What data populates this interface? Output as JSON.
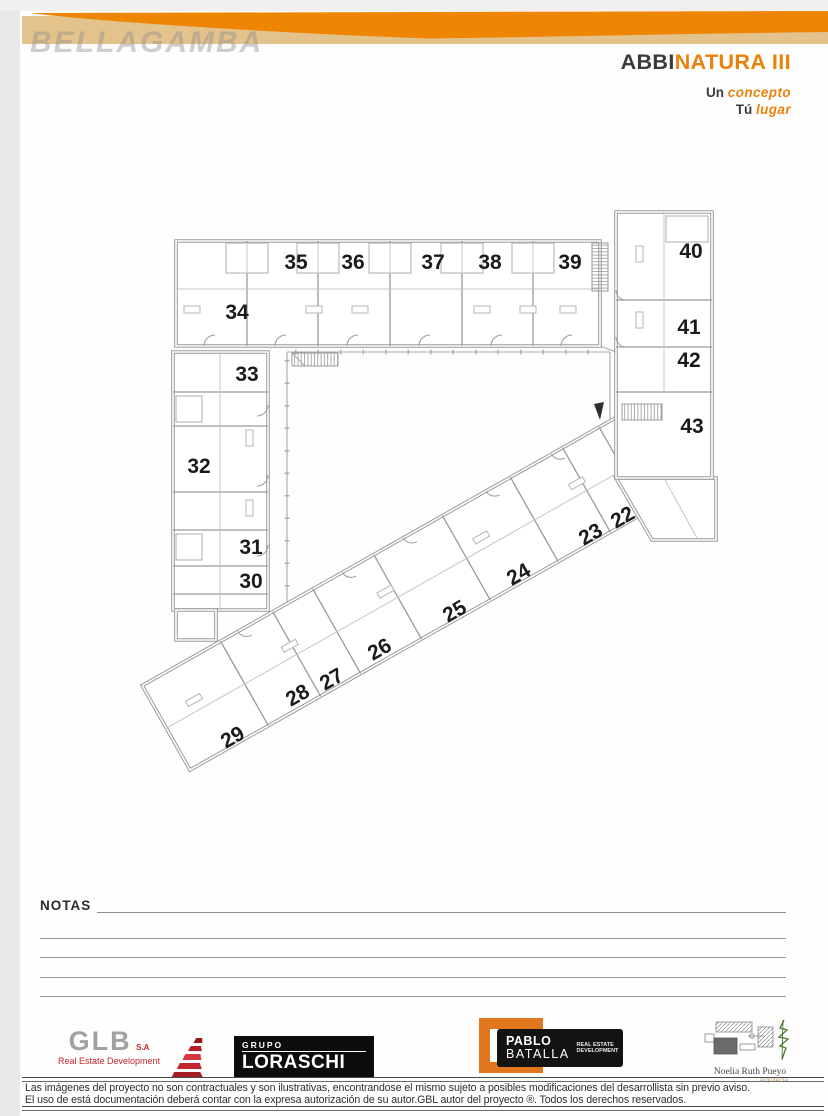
{
  "header": {
    "watermark": "BELLAGAMBA",
    "project_dark": "ABBI",
    "project_orange": "NATURA III",
    "tagline1_dark": "Un",
    "tagline1_orange": "concepto",
    "tagline2_dark": "Tú",
    "tagline2_orange": "lugar"
  },
  "colors": {
    "accent_orange": "#EE8503",
    "banner_tan": "#E3C28C",
    "title_gray": "#3B3B3B",
    "wall_gray": "#9A9A9A",
    "logo_red": "#C2262B"
  },
  "plan": {
    "units": [
      {
        "label": "34",
        "x": 237,
        "y": 313,
        "rot": 0
      },
      {
        "label": "35",
        "x": 296,
        "y": 263,
        "rot": 0
      },
      {
        "label": "36",
        "x": 353,
        "y": 263,
        "rot": 0
      },
      {
        "label": "37",
        "x": 433,
        "y": 263,
        "rot": 0
      },
      {
        "label": "38",
        "x": 490,
        "y": 263,
        "rot": 0
      },
      {
        "label": "39",
        "x": 570,
        "y": 263,
        "rot": 0
      },
      {
        "label": "40",
        "x": 691,
        "y": 252,
        "rot": 0
      },
      {
        "label": "41",
        "x": 689,
        "y": 328,
        "rot": 0
      },
      {
        "label": "42",
        "x": 689,
        "y": 361,
        "rot": 0
      },
      {
        "label": "43",
        "x": 692,
        "y": 427,
        "rot": 0
      },
      {
        "label": "33",
        "x": 247,
        "y": 375,
        "rot": 0
      },
      {
        "label": "32",
        "x": 199,
        "y": 467,
        "rot": 0
      },
      {
        "label": "31",
        "x": 251,
        "y": 548,
        "rot": 0
      },
      {
        "label": "30",
        "x": 251,
        "y": 582,
        "rot": 0
      },
      {
        "label": "29",
        "x": 233,
        "y": 738,
        "rot": -30
      },
      {
        "label": "28",
        "x": 298,
        "y": 696,
        "rot": -30
      },
      {
        "label": "27",
        "x": 332,
        "y": 680,
        "rot": -30
      },
      {
        "label": "26",
        "x": 380,
        "y": 650,
        "rot": -30
      },
      {
        "label": "25",
        "x": 455,
        "y": 612,
        "rot": -30
      },
      {
        "label": "24",
        "x": 519,
        "y": 575,
        "rot": -30
      },
      {
        "label": "23",
        "x": 591,
        "y": 535,
        "rot": -30
      },
      {
        "label": "22",
        "x": 623,
        "y": 518,
        "rot": -30
      }
    ]
  },
  "notes": {
    "label": "NOTAS"
  },
  "footer": {
    "glb": {
      "name": "GLB",
      "suffix": "S.A",
      "subtitle": "Real Estate Development"
    },
    "loraschi": {
      "group": "GRUPO",
      "name": "LORASCHI"
    },
    "batalla": {
      "first": "PABLO",
      "last": "BATALLA",
      "tag1": "REAL ESTATE",
      "tag2": "DEVELOPMENT"
    },
    "pueyo": {
      "name": "Noelia Ruth Pueyo",
      "subtitle": "arquitecta"
    },
    "disclaimer1": "Las imágenes del proyecto no son contractuales y son ilustrativas, encontrandose el mismo sujeto a posibles modificaciones del desarrollista sin previo aviso.",
    "disclaimer2": "El uso de está documentación deberá contar con la expresa autorización de su autor.GBL  autor del proyecto ®.  Todos los derechos reservados."
  }
}
